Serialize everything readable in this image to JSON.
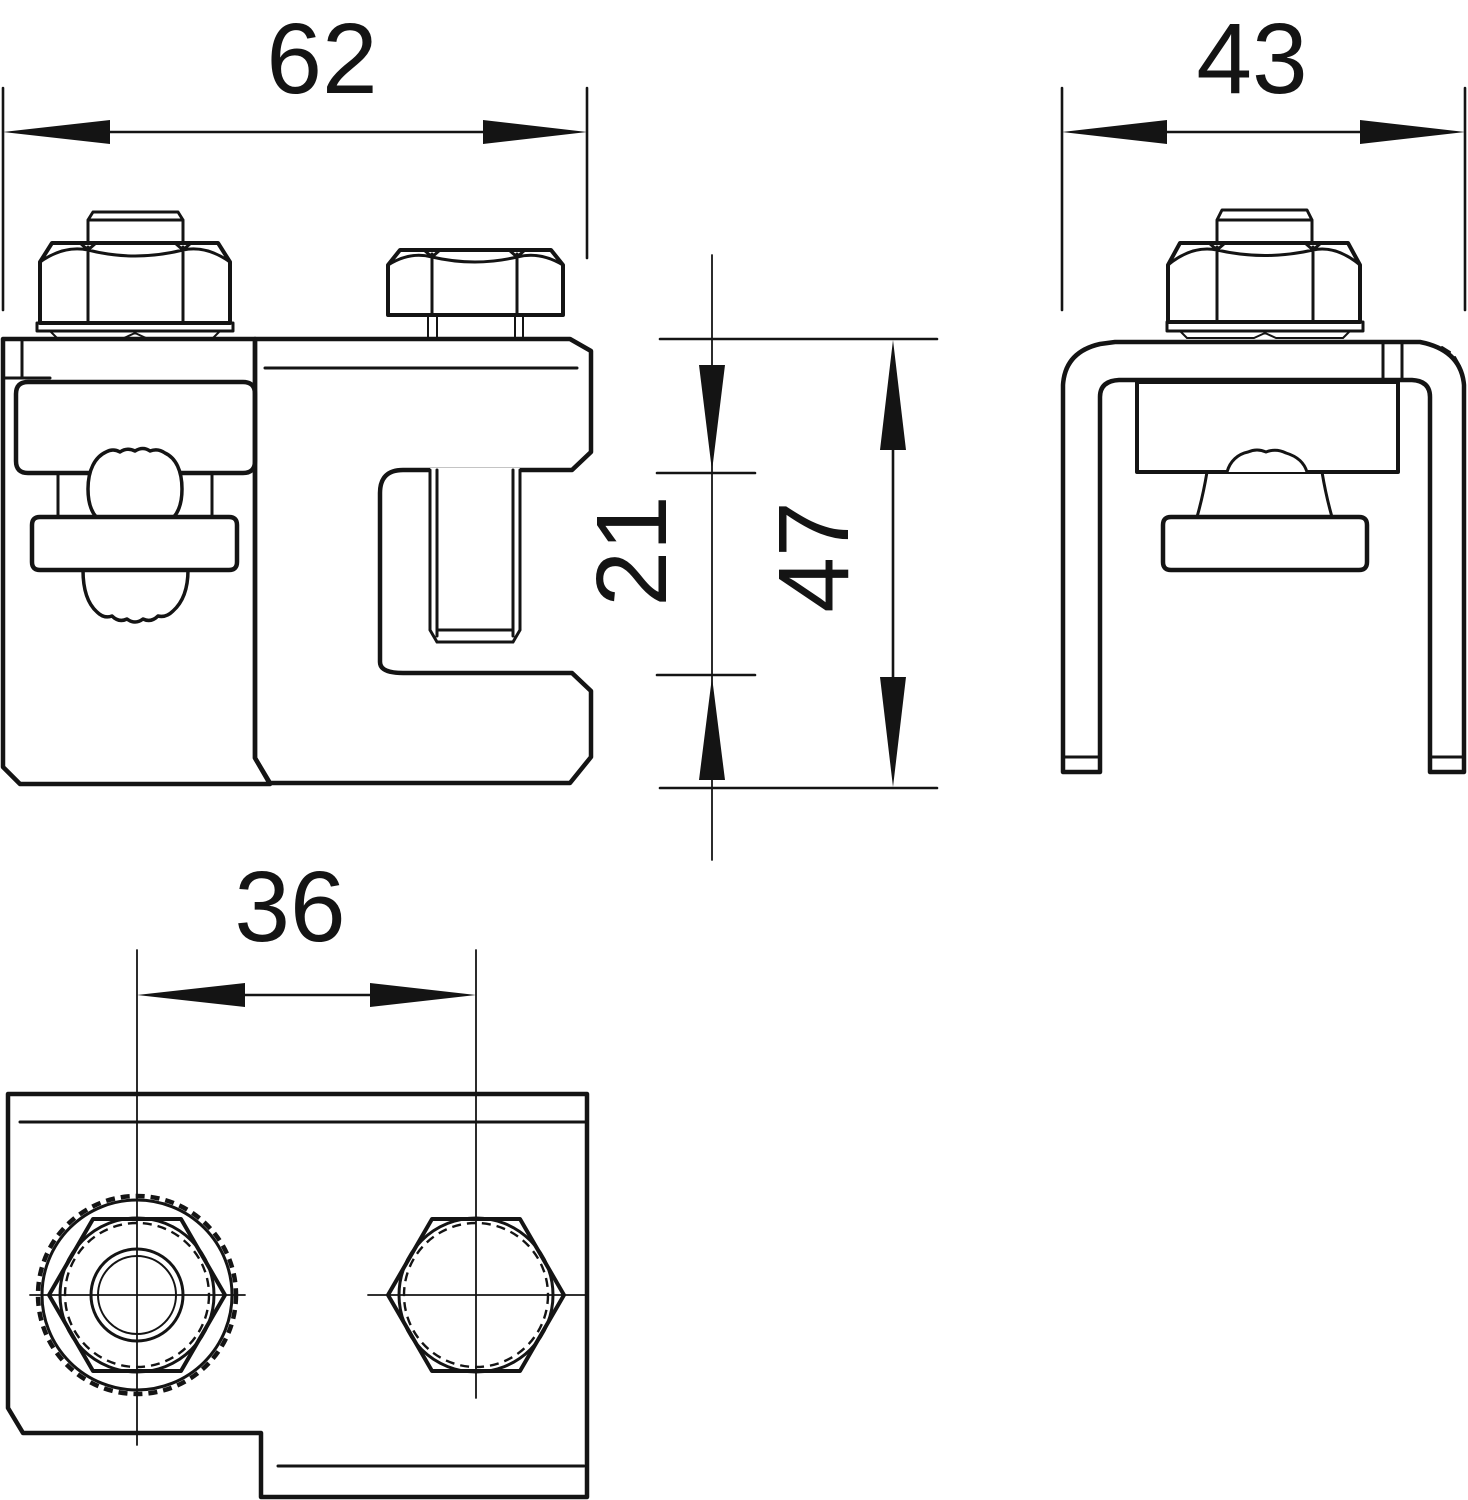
{
  "drawing": {
    "kind": "dimensioned engineering drawing, three orthographic views of a busbar/earthing clamp",
    "colors": {
      "line": "#141414",
      "background": "#ffffff"
    },
    "dims": {
      "front_width": "62",
      "side_width": "43",
      "clamp_opening": "21",
      "overall_height": "47",
      "hole_spacing": "36"
    }
  }
}
